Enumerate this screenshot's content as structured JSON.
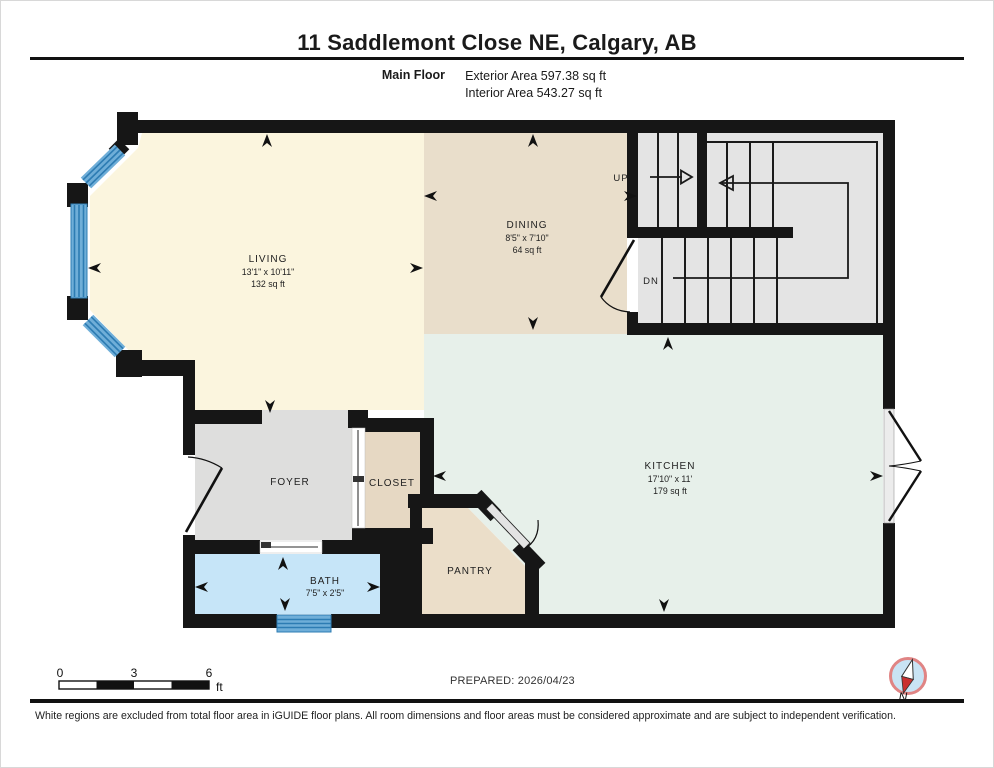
{
  "header": {
    "title": "11 Saddlemont Close NE, Calgary, AB",
    "floor_label": "Main Floor",
    "exterior_area": "Exterior Area 597.38 sq ft",
    "interior_area": "Interior Area 543.27 sq ft"
  },
  "rooms": {
    "living": {
      "name": "LIVING",
      "dims": "13'1\" x 10'11\"",
      "area": "132 sq ft"
    },
    "dining": {
      "name": "DINING",
      "dims": "8'5\" x 7'10\"",
      "area": "64 sq ft"
    },
    "kitchen": {
      "name": "KITCHEN",
      "dims": "17'10\" x 11'",
      "area": "179 sq ft"
    },
    "foyer": {
      "name": "FOYER"
    },
    "closet": {
      "name": "CLOSET"
    },
    "bath": {
      "name": "BATH",
      "dims": "7'5\" x 2'5\""
    },
    "pantry": {
      "name": "PANTRY"
    }
  },
  "stairs": {
    "up_label": "UP",
    "down_label": "DN"
  },
  "scale_bar": {
    "tick0": "0",
    "tick3": "3",
    "tick6": "6",
    "unit": "ft"
  },
  "footer": {
    "prepared": "PREPARED: 2026/04/23",
    "disclaimer": "White regions are excluded from total floor area in iGUIDE floor plans. All room dimensions and floor areas must be considered approximate and are subject to independent verification.",
    "compass_label": "N"
  },
  "colors": {
    "wall": "#161616",
    "living": "#FBF5DE",
    "dining": "#E9DECB",
    "kitchen": "#E7F0EA",
    "foyer": "#DEDEDD",
    "closet": "#E6D8C3",
    "pantry": "#EBDEC9",
    "bath": "#C6E5F8",
    "stairs": "#E4E4E4",
    "window": "#6FAED8",
    "window_stripe": "#2D7CB3",
    "compass_ring": "#E08484",
    "compass_fill": "#C9E3F4",
    "compass_needle": "#C93030"
  }
}
